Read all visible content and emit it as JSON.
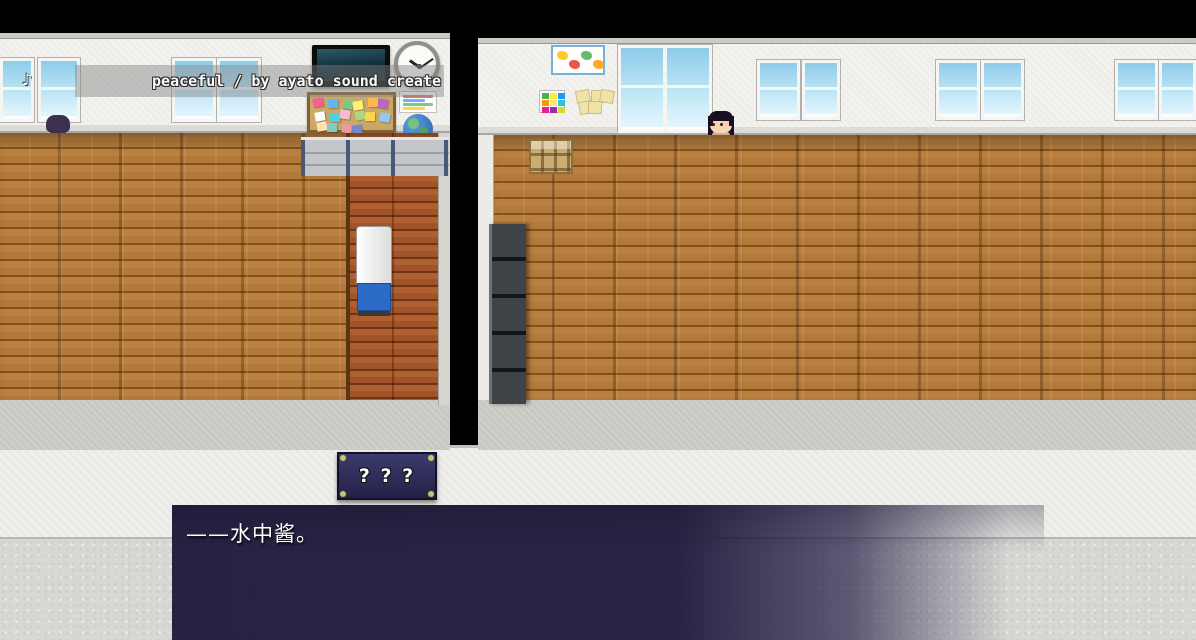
{
  "bgm_credit": {
    "text": "peaceful / by ayato sound create",
    "note_icon": "♪"
  },
  "door_sign": {
    "text": "? ? ?"
  },
  "dialogue": {
    "text": "——水中酱。"
  },
  "palette": {
    "wall": "#f3f2ee",
    "floor": "#b1793a",
    "floorline": "#7e5220",
    "sideroomfloor": "#a1542a",
    "hallfloor": "#d8d7d3",
    "hallwall": "#efeeea",
    "desk": "#b4682c",
    "deskdark": "#7a3f10",
    "glass1": "#8ecbe9",
    "glass2": "#e8f7fd",
    "dialog": "#201b3d",
    "sign": "#2e2c55",
    "signcorner": "#c6c671",
    "credit-band": "rgba(130,130,130,0.45)",
    "locker": "#3f4347",
    "cork": "#c9a868",
    "corkframe": "#826032",
    "rack": "#c9ad72",
    "cooler-blue": "#2b6cc8"
  },
  "scene": {
    "windows_left": [
      {
        "x": 0,
        "w": 34
      },
      {
        "x": 38,
        "w": 42
      },
      {
        "x": 172,
        "w": 44
      },
      {
        "x": 217,
        "w": 44
      }
    ],
    "windows_left_y": 58,
    "windows_left_h": 64,
    "window_tall": {
      "x": 618,
      "y": 45,
      "w": 94,
      "h": 88
    },
    "windows_right": [
      {
        "x": 757,
        "w": 43
      },
      {
        "x": 802,
        "w": 38
      },
      {
        "x": 936,
        "w": 44
      },
      {
        "x": 981,
        "w": 43
      },
      {
        "x": 1115,
        "w": 43
      },
      {
        "x": 1159,
        "w": 37
      }
    ],
    "windows_right_y": 60,
    "windows_right_h": 60,
    "openings": [
      {
        "x": 2,
        "y": 410,
        "w": 250,
        "h": 33
      },
      {
        "x": 357,
        "y": 409,
        "w": 81,
        "h": 34
      },
      {
        "x": 488,
        "y": 406,
        "w": 82,
        "h": 34
      },
      {
        "x": 668,
        "y": 408,
        "w": 528,
        "h": 34
      }
    ],
    "doorways": [
      {
        "x": 261,
        "w": 90
      },
      {
        "x": 575,
        "w": 91
      }
    ],
    "doors": [
      {
        "x": 261,
        "w": 90,
        "win_side": "right"
      },
      {
        "x": 575,
        "w": 91,
        "win_side": "left"
      }
    ],
    "desk_unit": {
      "w": 70,
      "h": 46
    },
    "desk_rows": [
      133,
      178,
      268,
      313
    ],
    "desk_cols_left": [
      -50,
      82,
      215
    ],
    "desk_cols_right": [
      620,
      757,
      892,
      1026,
      1160
    ],
    "board_note_colors": [
      "#f06292",
      "#64b5f6",
      "#81c784",
      "#fff176",
      "#ffb74d",
      "#ba68c8",
      "#ffffff",
      "#4dd0e1",
      "#f8bbd0",
      "#aed581",
      "#ffd54f",
      "#90caf9",
      "#ffe0b2",
      "#80cbc4",
      "#ef9a9a",
      "#7986cb"
    ],
    "grid_poster_colors": [
      "#4caf50",
      "#ffeb3b",
      "#2196f3",
      "#ff9800",
      "#ffe082",
      "#26c6da",
      "#e91e8c",
      "#9c27b0",
      "#cddc39"
    ],
    "map_blob_colors": [
      "#ffca28",
      "#ef5350",
      "#66bb6a",
      "#ffa726"
    ],
    "poster_line_colors": [
      "#e57373",
      "#64b5f6",
      "#81c784",
      "#ffd54f"
    ],
    "characters": [
      {
        "id": "sailor-girl-back",
        "x": 44,
        "y": 112,
        "hair": "#3c3050",
        "top": "#e8eef4",
        "bottom": "#3568c8",
        "facing": "back"
      },
      {
        "id": "suit-teacher",
        "x": 179,
        "y": 160,
        "hair": "#57603a",
        "top": "#2c3454",
        "bottom": "#2c3454",
        "facing": "front"
      },
      {
        "id": "red-uniform-back",
        "x": 403,
        "y": 200,
        "hair": "#3f5030",
        "top": "#a02020",
        "bottom": "#801818",
        "facing": "back"
      },
      {
        "id": "sailor-girl-standing",
        "x": 584,
        "y": 154,
        "hair": "#352a48",
        "top": "#cfe0ee",
        "bottom": "#4878c8",
        "facing": "right"
      },
      {
        "id": "long-black-hair",
        "x": 707,
        "y": 108,
        "hair": "#181022",
        "sheen": "#c04898",
        "top": "#c8b088",
        "bottom": "#6a5a40",
        "facing": "left",
        "longhair": true
      },
      {
        "id": "cyan-hair-girl",
        "x": 711,
        "y": 159,
        "hair": "#38c8e8",
        "top": "#3878d8",
        "bottom": "#2858b8",
        "facing": "front",
        "bighair": true
      },
      {
        "id": "green-hair-student",
        "x": 989,
        "y": 156,
        "hair": "#2e4428",
        "top": "#39425c",
        "bottom": "#39425c",
        "facing": "left"
      },
      {
        "id": "sailor-girl-lower",
        "x": 584,
        "y": 292,
        "hair": "#352a48",
        "top": "#cfe0ee",
        "bottom": "#4878c8",
        "facing": "left"
      },
      {
        "id": "hall-red-student",
        "x": 891,
        "y": 592,
        "hair": "#26222a",
        "top": "#8c2828",
        "bottom": "#444444",
        "facing": "back"
      },
      {
        "id": "hall-green-student",
        "x": 1031,
        "y": 594,
        "hair": "#32491f",
        "top": "#5a6478",
        "bottom": "#444444",
        "facing": "left"
      },
      {
        "id": "shadowed-figure",
        "x": 368,
        "y": 596,
        "hair": "#101018",
        "top": "#15121f",
        "bottom": "#15121f",
        "facing": "back",
        "shadowed": true
      }
    ]
  }
}
